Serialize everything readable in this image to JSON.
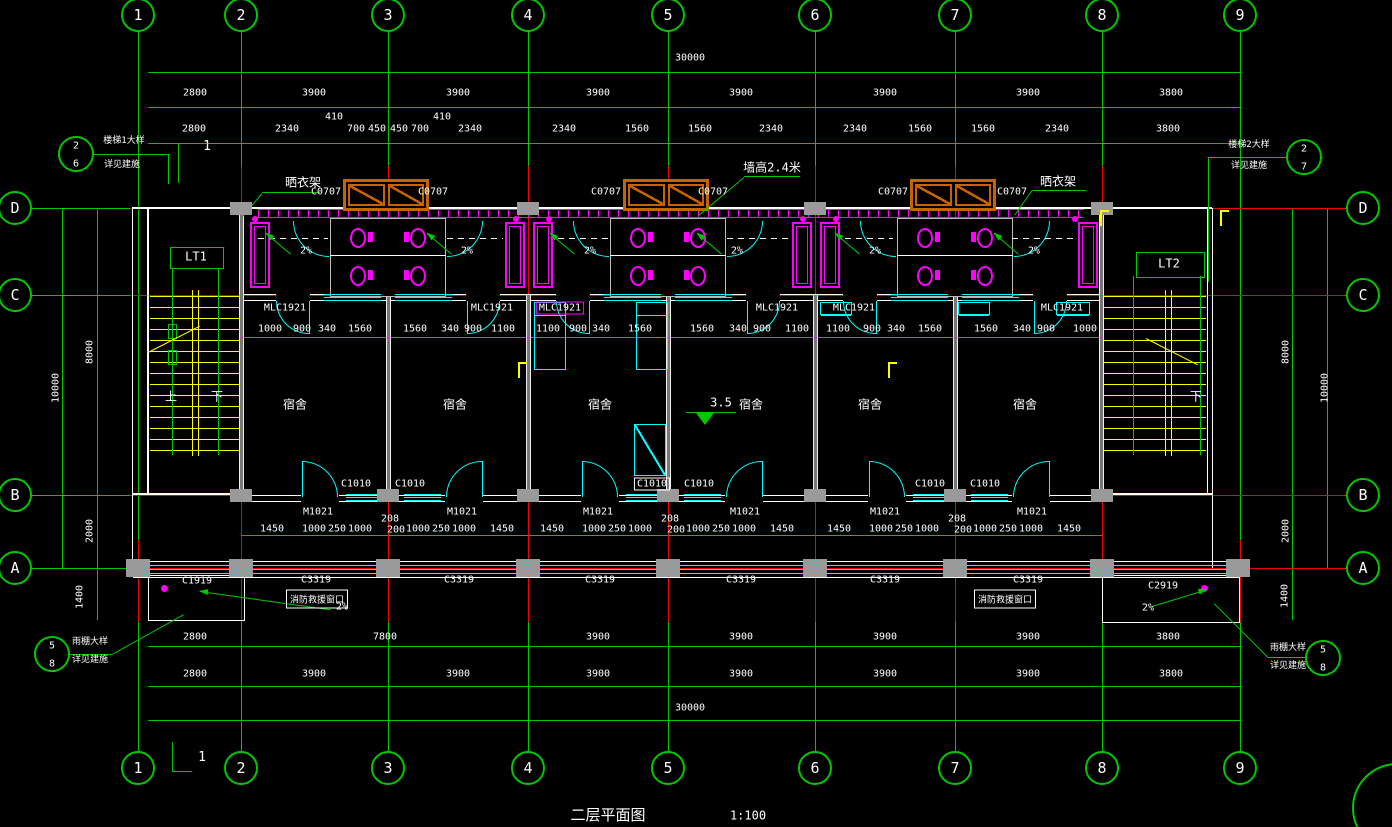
{
  "title": {
    "text": "二层平面图",
    "scale": "1:100"
  },
  "axes": {
    "cols": [
      "1",
      "2",
      "3",
      "4",
      "5",
      "6",
      "7",
      "8",
      "9"
    ],
    "rows": [
      "D",
      "C",
      "B",
      "A"
    ]
  },
  "dims": {
    "total": "30000",
    "row_top": [
      "2800",
      "3900",
      "3900",
      "3900",
      "3900",
      "3900",
      "3900",
      "3800"
    ],
    "row_detail": [
      "2800",
      "2340",
      "410",
      "700",
      "450",
      "450",
      "700",
      "410",
      "2340",
      "2340",
      "1560",
      "1560",
      "2340",
      "2340",
      "1560",
      "1560",
      "2340",
      "3800"
    ],
    "row_window": [
      "1000",
      "900",
      "340",
      "1560",
      "1560",
      "340",
      "900",
      "1100",
      "1100",
      "900",
      "340",
      "1560",
      "1560",
      "340",
      "900",
      "1100",
      "1100",
      "900",
      "340",
      "1560",
      "1560",
      "340",
      "900",
      "1000"
    ],
    "row_door": [
      "1450",
      "1000",
      "250",
      "1000",
      "208",
      "200",
      "1000",
      "250",
      "1000",
      "1450"
    ],
    "row_bottom1": [
      "2800",
      "7800",
      "3900",
      "3900",
      "3900",
      "3900",
      "3800"
    ],
    "row_bottom2": [
      "2800",
      "3900",
      "3900",
      "3900",
      "3900",
      "3900",
      "3900",
      "3800"
    ],
    "side_left": [
      "10000",
      "8000",
      "2000",
      "1400"
    ],
    "side_right": [
      "8000",
      "10000",
      "2000",
      "1400"
    ]
  },
  "tags": {
    "combo_window": "MLC1921",
    "high_window": "C0707",
    "room_window": "C1010",
    "room_door": "M1021",
    "corridor_window": "C3319",
    "canopy_window_left": "C1919",
    "canopy_window_right": "C2919"
  },
  "rooms": {
    "dorm": "宿舍",
    "level": "3.5"
  },
  "stairs": {
    "left": "LT1",
    "right": "LT2",
    "up": "上",
    "down": "下"
  },
  "notes": {
    "drying_rack": "晒衣架",
    "wall_height": "墙高2.4米",
    "slope": "2%",
    "fire_window": "消防救援窗口",
    "section": "1"
  },
  "callouts": {
    "stair1": {
      "num": "2",
      "sheet": "6",
      "line1": "楼梯1大样",
      "line2": "详见建施"
    },
    "stair2": {
      "num": "2",
      "sheet": "7",
      "line1": "楼梯2大样",
      "line2": "详见建施"
    },
    "canopy1": {
      "num": "5",
      "sheet": "8",
      "line1": "雨棚大样",
      "line2": "详见建施"
    },
    "canopy2": {
      "num": "5",
      "sheet": "8",
      "line1": "雨棚大样",
      "line2": "详见建施"
    }
  },
  "colors": {
    "bg": "#000000",
    "grid": "#00c800",
    "axis": "#f00000",
    "wall": "#ffffff",
    "window": "#00ffff",
    "fixture": "#ff00ff",
    "high_window": "#c86400",
    "stair": "#ffff00",
    "column": "#9a9a9a",
    "text": "#ffffff"
  }
}
